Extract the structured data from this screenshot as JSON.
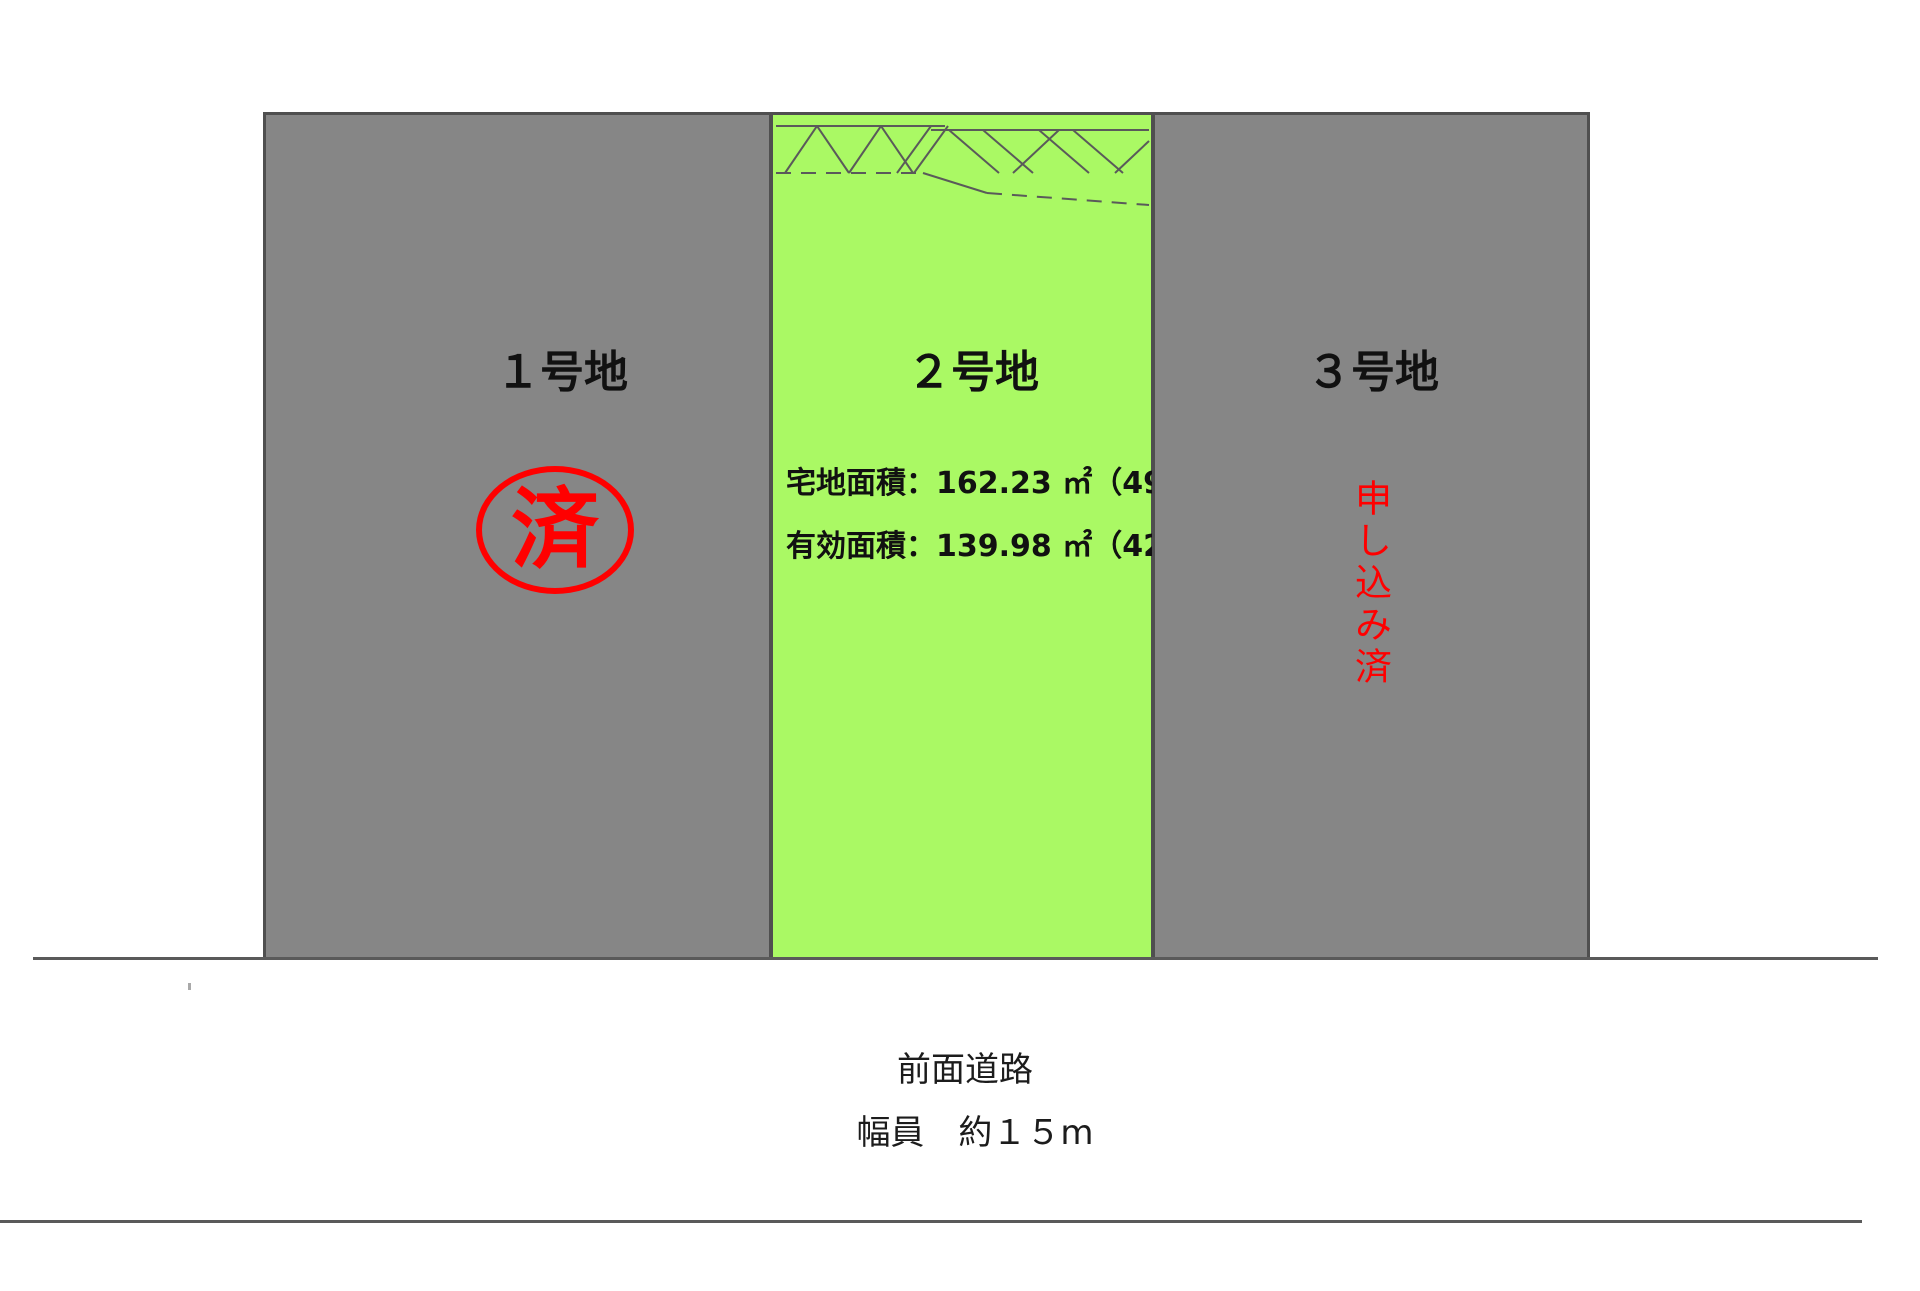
{
  "diagram": {
    "type": "land-plot-layout",
    "colors": {
      "plot_unavailable_gray": "#868686",
      "plot_available_green": "#aaf964",
      "boundary_line": "#4f4f4f",
      "status_red": "#ff0000",
      "text_black": "#111111"
    },
    "plots": {
      "plot1": {
        "label": "１号地",
        "status": "sold",
        "stamp": "済"
      },
      "plot2": {
        "label": "２号地",
        "area_line1": "宅地面積：162.23 ㎡（49.07 坪）",
        "area_line2": "有効面積：139.98 ㎡（42.34 坪）",
        "lot_area_m2": 162.23,
        "lot_area_tsubo": 49.07,
        "effective_area_m2": 139.98,
        "effective_area_tsubo": 42.34
      },
      "plot3": {
        "label": "３号地",
        "status": "申し込み済"
      }
    },
    "road": {
      "name": "前面道路",
      "width_note": "幅員　約１５m"
    }
  }
}
